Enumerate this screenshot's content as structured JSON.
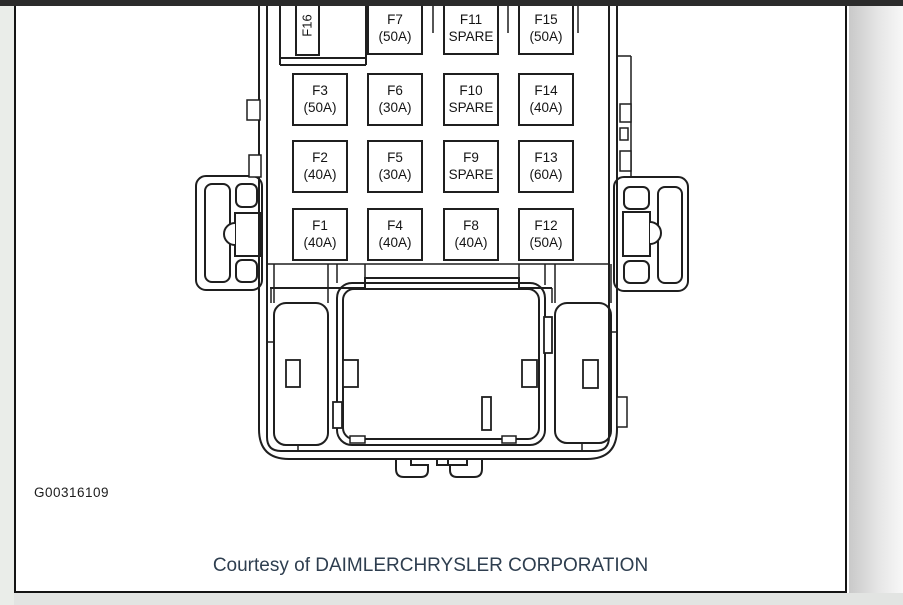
{
  "figure": {
    "id": "G00316109",
    "caption": "Courtesy of DAIMLERCHRYSLER CORPORATION"
  },
  "fuse_panel": {
    "rotated_fuse": {
      "name": "F16"
    },
    "fuses": [
      {
        "name": "F7",
        "rating": "(50A)"
      },
      {
        "name": "F11",
        "rating": "SPARE"
      },
      {
        "name": "F15",
        "rating": "(50A)"
      },
      {
        "name": "F3",
        "rating": "(50A)"
      },
      {
        "name": "F6",
        "rating": "(30A)"
      },
      {
        "name": "F10",
        "rating": "SPARE"
      },
      {
        "name": "F14",
        "rating": "(40A)"
      },
      {
        "name": "F2",
        "rating": "(40A)"
      },
      {
        "name": "F5",
        "rating": "(30A)"
      },
      {
        "name": "F9",
        "rating": "SPARE"
      },
      {
        "name": "F13",
        "rating": "(60A)"
      },
      {
        "name": "F1",
        "rating": "(40A)"
      },
      {
        "name": "F4",
        "rating": "(40A)"
      },
      {
        "name": "F8",
        "rating": "(40A)"
      },
      {
        "name": "F12",
        "rating": "(50A)"
      }
    ]
  },
  "colors": {
    "caption_text": "#2e3e4f",
    "diagram_ink": "#1f1f1f",
    "viewer_bar": "#2b2b2b"
  }
}
